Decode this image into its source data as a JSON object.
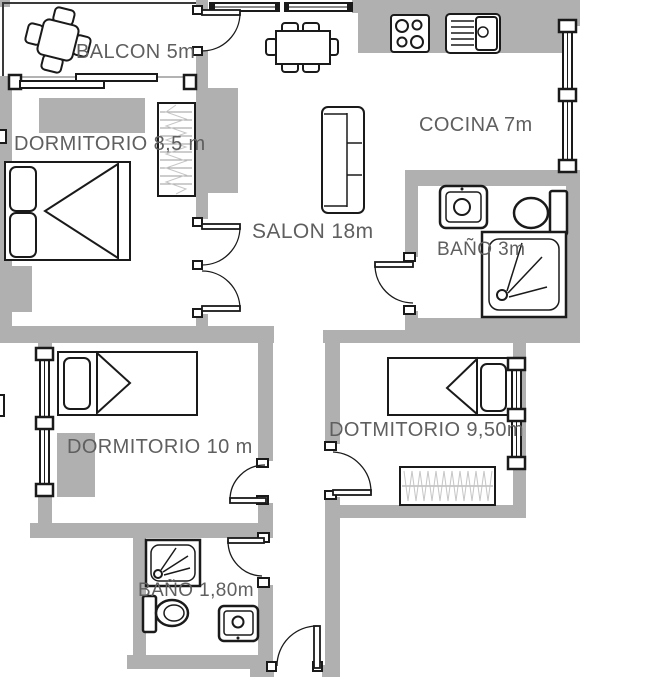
{
  "plan": {
    "type": "apartment-floor-plan",
    "colors": {
      "wall": "#b0b0b0",
      "line": "#1a1a1a",
      "label": "#5f5f5f",
      "hatch_light": "#c6c6c6",
      "hatch_dark": "#9b9b9b"
    },
    "rooms": [
      {
        "id": "balcon",
        "label": "BALCON 5m"
      },
      {
        "id": "dormitorio-1",
        "label": "DORMITORIO 8,5 m"
      },
      {
        "id": "salon",
        "label": "SALON 18m"
      },
      {
        "id": "cocina",
        "label": "COCINA 7m"
      },
      {
        "id": "bano-1",
        "label": "BAÑO 3m"
      },
      {
        "id": "dormitorio-2",
        "label": "DORMITORIO 10 m"
      },
      {
        "id": "dormitorio-3",
        "label": "DOTMITORIO 9,50m"
      },
      {
        "id": "bano-2",
        "label": "BAÑO 1,80m"
      }
    ]
  }
}
